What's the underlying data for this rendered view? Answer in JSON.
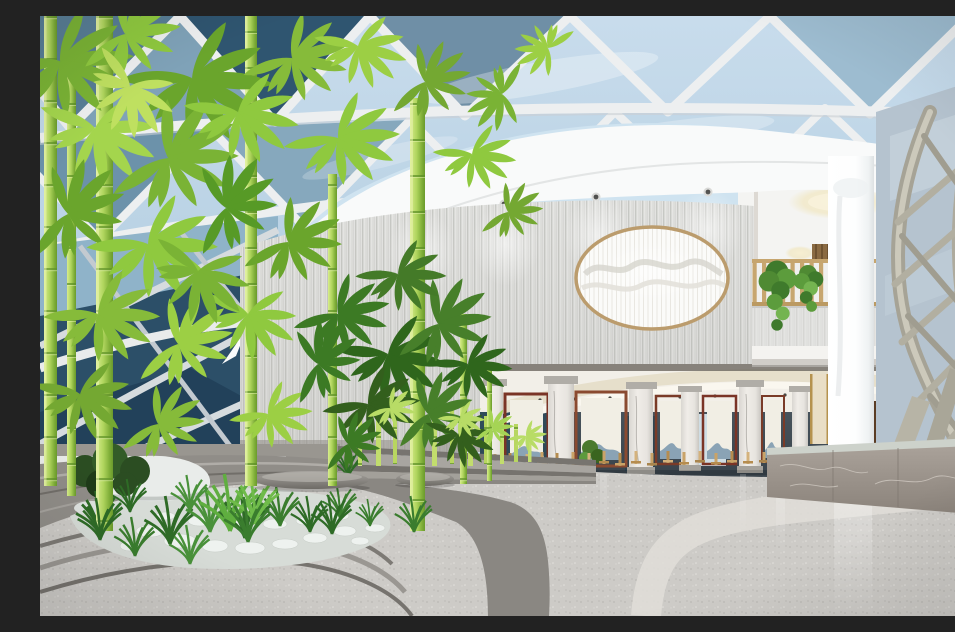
{
  "scene": {
    "description": "Daylit hotel atrium lobby rendering: triangulated glass dome skylight above a curved white fascia with recessed downlights; a striated stone feature wall holds a gold-rimmed oval backlit mountain artwork; a bamboo zen garden with white pebbles, grasses, a white rock and curved stone terraces sits at left with stone pebble benches; behind, a colonnaded dining area with marble columns, wooden lattice screens and rows of light wood chairs; at right a second-floor balcony with wooden slat railing and trailing plants, a glossy white column, a curved structural lattice shell over blue glazing, and a gray marble reception counter on a polished speckled terrazzo floor with a curved white inlay band.",
    "lighting": "daylight",
    "style": "3d-architectural-rendering"
  },
  "palette": {
    "sky_glass": "#bfd7e8",
    "glass_dark_panel": "#2f5570",
    "mullion_white": "#edeff0",
    "fascia_white": "#f9fafa",
    "feature_wall": "#e6e6e4",
    "artwork_ring_gold": "#bb9c6d",
    "artwork_panel": "#fbfbf9",
    "bamboo_leaf_bright": "#8fc93f",
    "bamboo_leaf_dark": "#3c7a24",
    "bamboo_stalk": "#aed45c",
    "balcony_slat_wood": "#c7a66f",
    "hanging_plant": "#4f8a33",
    "shell_beam": "#aaa79a",
    "shell_glazing": "#b5c3cf",
    "screen_frame_wood": "#7a3b28",
    "screen_panel": "#f1eee4",
    "screen_mountain": "#8aa3b5",
    "chair_wood": "#c9a368",
    "marble_column": "#efece7",
    "counter_marble": "#9a928a",
    "counter_top": "#cdd2cb",
    "floor_terrazzo": "#cdcbc7",
    "floor_inlay_band": "#e0ded8",
    "terrace_stone": "#8a8782",
    "pebble_white": "#eef2ef",
    "grass_green": "#2e6b26",
    "planter_box": "#f2f4f2",
    "rock_white": "#e9ecea"
  },
  "elements": {
    "skylight": "triangulated-glass-dome",
    "artwork": "oval-backlit-mountain-panel",
    "garden": "bamboo-zen-garden",
    "seating": "stone-pebble-benches",
    "dining": "colonnade-with-lattice-screens",
    "balcony": "slat-railing-with-trailing-plants",
    "structure": "curved-lattice-shell",
    "counter": "gray-marble-reception-counter",
    "floor": "speckled-terrazzo-with-curved-inlay",
    "downlight_count": 4,
    "ceiling_cove_count": 2,
    "bench_count": 2,
    "planter_box_count": 3
  }
}
